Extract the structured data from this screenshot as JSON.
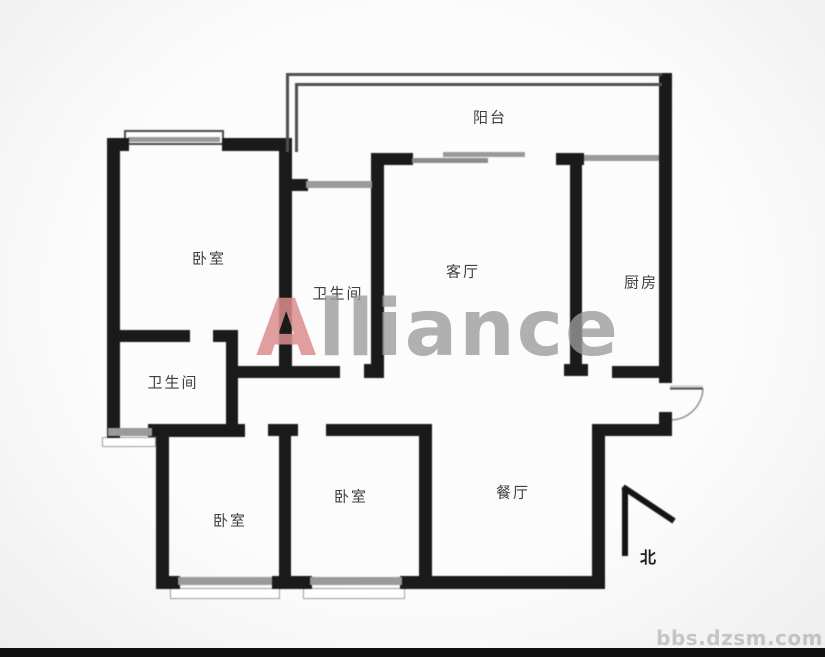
{
  "rooms": {
    "balcony": "阳台",
    "master_bedroom": "卧室",
    "inner_bathroom": "卫生间",
    "living_room": "客厅",
    "kitchen": "厨房",
    "outer_bathroom": "卫生间",
    "left_bedroom": "卧室",
    "middle_bedroom": "卧室",
    "dining_room": "餐厅"
  },
  "compass": {
    "north_label": "北"
  },
  "watermarks": {
    "brand_initial": "A",
    "brand_rest": "lliance",
    "site": "bbs.dzsm.com"
  },
  "colors": {
    "wall": "#1a1a1a",
    "window": "#9a9a9a",
    "brand_red": "#dd8e8e",
    "brand_gray": "#9b9b9b",
    "label_text": "#404040"
  }
}
